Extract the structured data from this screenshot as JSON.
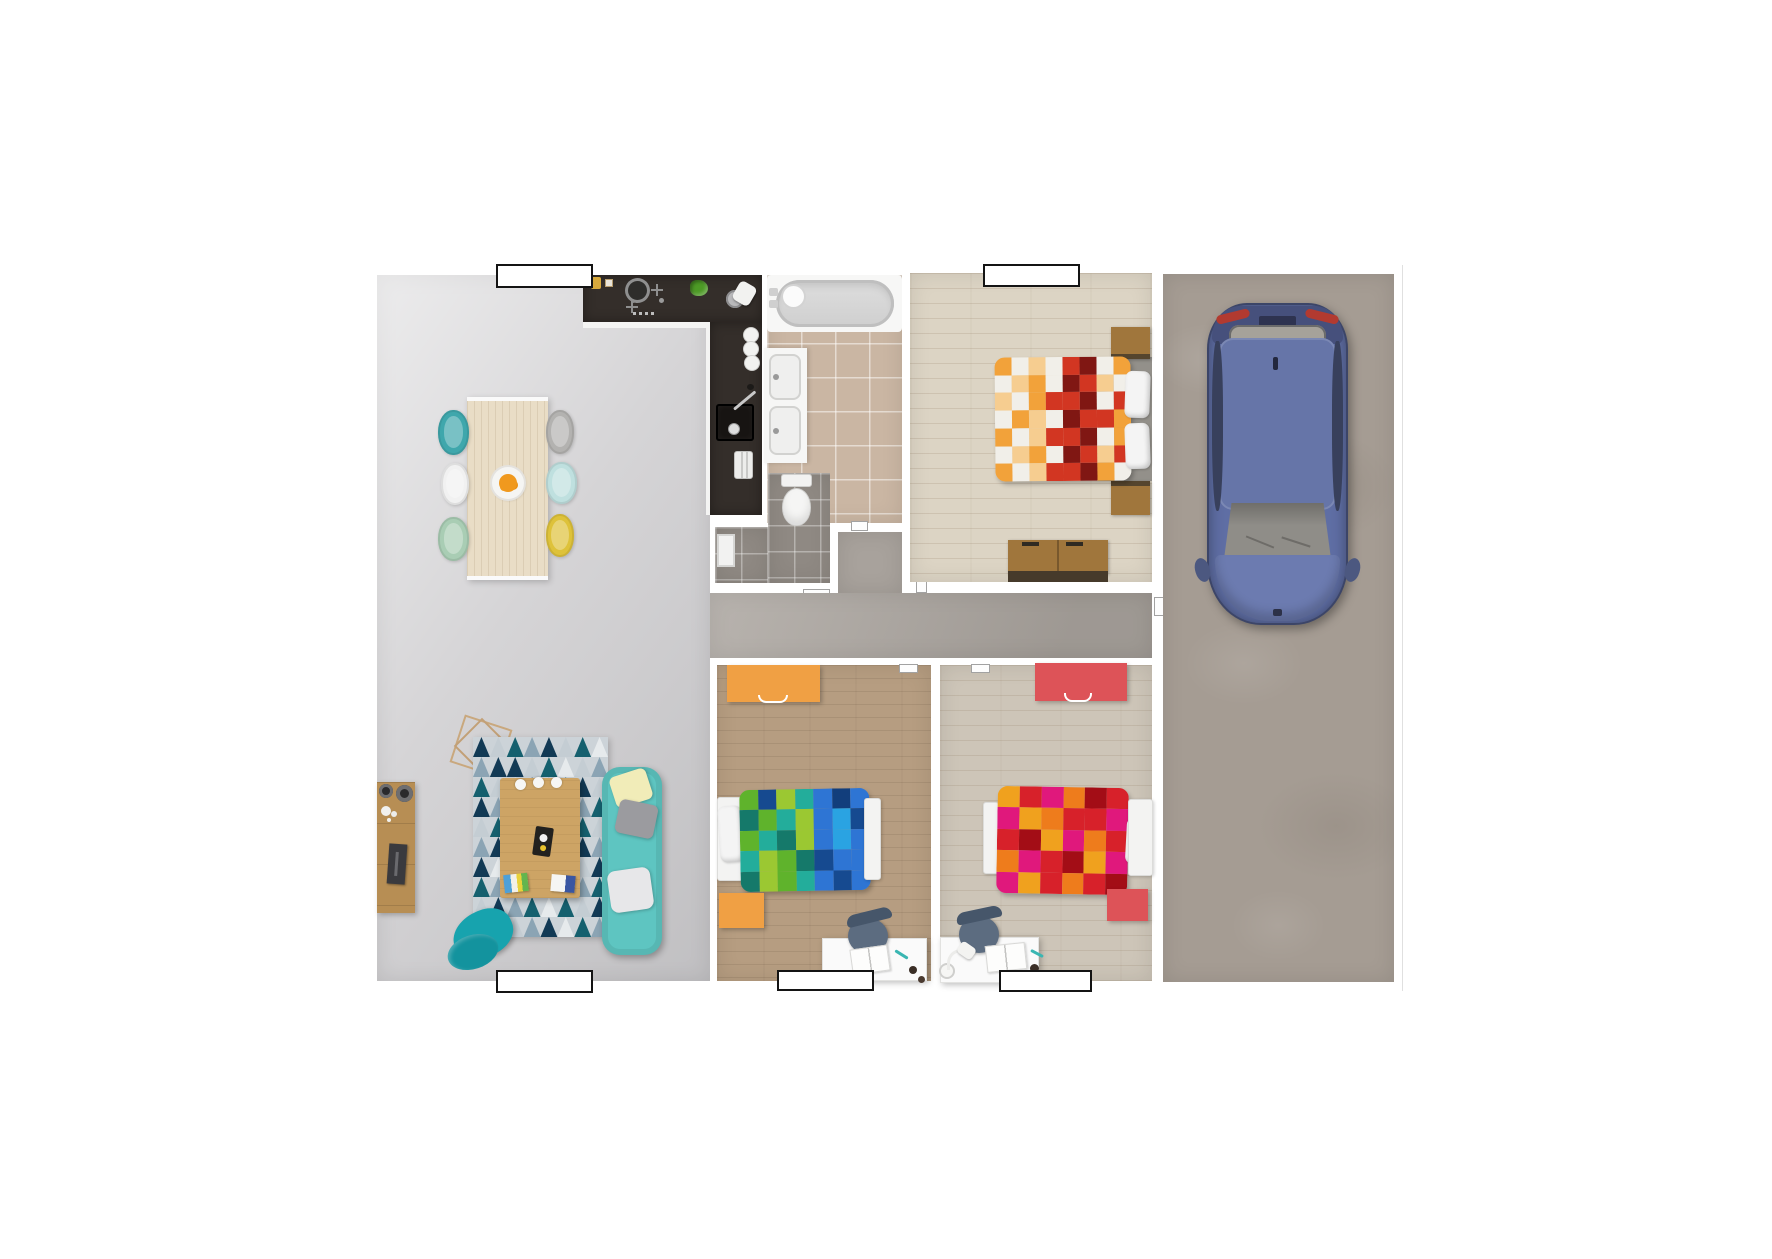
{
  "page": {
    "background": "#ffffff"
  },
  "plan": {
    "labels": [
      {
        "id": "label-kitchen-area",
        "text": ""
      },
      {
        "id": "label-bedroom-top",
        "text": ""
      },
      {
        "id": "label-living-room",
        "text": ""
      },
      {
        "id": "label-kid-bedroom-1",
        "text": ""
      },
      {
        "id": "label-kid-bedroom-2",
        "text": ""
      }
    ]
  },
  "palette": {
    "background": "#ffffff",
    "label_border": "#141414",
    "living_floor": "#d5d4d6",
    "hallway_floor": "#a8a29c",
    "bathroom_floor": "#cab6a3",
    "wc_floor": "#8f8983",
    "bedroom_floor": "#dcd4c4",
    "kid1_floor": "#b69d81",
    "kid2_floor": "#cdc5b8",
    "garage_floor": "#a59c93",
    "kitchen_counter": "#342e2a",
    "counter_edge": "#f4f4f3",
    "sink_basin": "#171412",
    "table_wood": "#e9ddc6",
    "coffee_table_wood": "#cda465",
    "sideboard_wood": "#b78e54",
    "nightstand_wood": "#a0763c",
    "dresser_base_dark": "#463a2b",
    "sofa": "#5ec5c1",
    "armchair": "#17a3ae",
    "pillow_yellow": "#f1ecb8",
    "pillow_gray": "#9b9b9f",
    "pillow_white": "#e7e7e9",
    "rug_base": "#ccd3d8",
    "pendant_wire": "#c9a87e",
    "dresser_orange": "#f0a044",
    "dresser_red": "#dd5358",
    "desk_chair": "#5c6c80",
    "desk_chair_back": "#46566a",
    "pen_teal": "#3ab6b2",
    "fruit_orange": "#f0991e",
    "lettuce_green": "#4d9a26",
    "jar_yellow": "#d7a93c",
    "bed_base_gray": "#93908a",
    "car_body": "#5f6ea4",
    "car_deck": "#46507c",
    "car_roof": "#6675a8",
    "car_hood": "#6c7bb0",
    "car_side_window": "#38405c",
    "car_windshield": "#8f8d88",
    "car_rear_window": "#a6a29a",
    "car_taillight": "#b23a30",
    "car_mirror": "#4c5880",
    "dining_chairs": [
      "#3fa7ac",
      "#f1f1f1",
      "#a9cdb4",
      "#b3b2b0",
      "#bfe0df",
      "#dec23a"
    ]
  },
  "rendering": {
    "rug": {
      "palette": [
        "#123a55",
        "#15606e",
        "#c4cdd3",
        "#8ba4b4",
        "#e6eaec"
      ],
      "grid": [
        "02130214",
        "30021423",
        "12403102",
        "03142031",
        "21030412",
        "30214203",
        "04123120",
        "13042031",
        "20314120",
        "01230413"
      ]
    },
    "master_duvet": {
      "palette": {
        "W": "#f1efe9",
        "O": "#f2a23a",
        "L": "#f6cd90",
        "R": "#d23622",
        "D": "#801713",
        "G": "#d9d7d2"
      },
      "grid": [
        "OWLWRDWO",
        "WLOWDRLW",
        "LWORRDWR",
        "WOLWDRRO",
        "OWLRRDWO",
        "WLOWDRLR",
        "OWLRRDOW"
      ]
    },
    "kid1_duvet": {
      "palette": {
        "A": "#5fb32c",
        "B": "#9bc832",
        "C": "#23ad9b",
        "D": "#15796a",
        "E": "#2e75d4",
        "F": "#2aa3e2",
        "G": "#164a90",
        "H": "#123e7c"
      },
      "grid": [
        "AGBCEHE",
        "DACBEFG",
        "ACDBEFE",
        "CBADGEE",
        "DBACEGE"
      ]
    },
    "kid2_duvet": {
      "palette": {
        "R": "#d7212a",
        "M": "#e0187c",
        "O": "#ee7c1c",
        "G": "#f0a11e",
        "C": "#a30d16",
        "P": "#c01060"
      },
      "grid": [
        "GRMOCR",
        "MGORRM",
        "RCGMOR",
        "OMRCGM",
        "MGRORC"
      ]
    }
  }
}
